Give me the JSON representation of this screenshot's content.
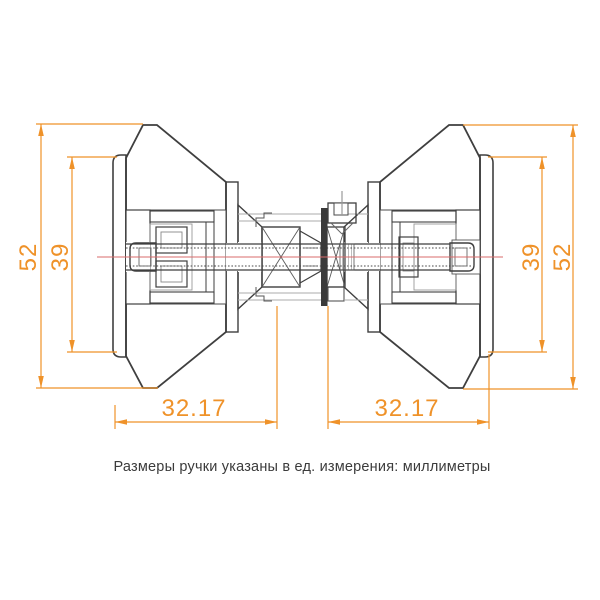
{
  "caption": "Размеры ручки указаны в ед. измерения: миллиметры",
  "dimensions": {
    "left_outer": "52",
    "left_inner": "39",
    "right_inner": "39",
    "right_outer": "52",
    "bottom_left": "32.17",
    "bottom_right": "32.17"
  },
  "colors": {
    "dimension": "#EF9229",
    "centerline": "#D96B6B",
    "outline": "#3F3F3F",
    "hidden_line": "#ABABAB",
    "caption_text": "#3B3B3B",
    "background": "#FFFFFF"
  }
}
